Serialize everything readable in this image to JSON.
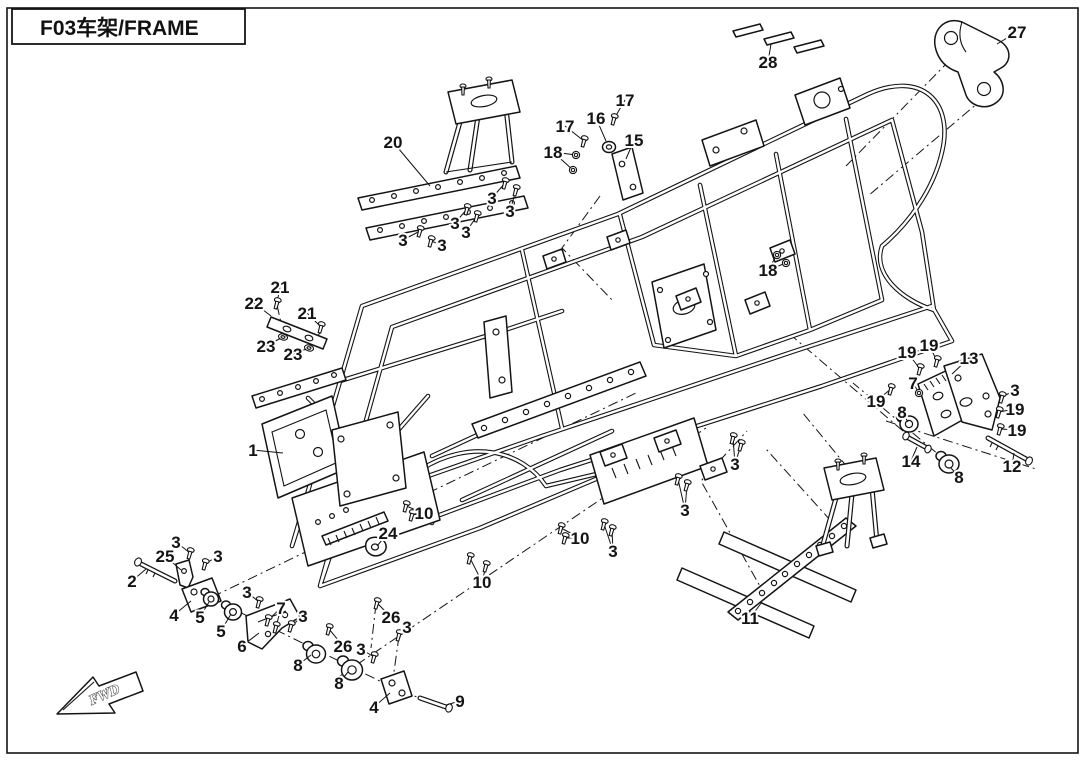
{
  "title": "F03车架/FRAME",
  "direction_label": "FWD",
  "colors": {
    "ink": "#141414",
    "paper": "#ffffff"
  },
  "callouts": [
    {
      "label": "20",
      "x": 393,
      "y": 142,
      "t": [
        [
          430,
          186
        ]
      ]
    },
    {
      "label": "3",
      "x": 492,
      "y": 198,
      "t": [
        [
          505,
          183
        ]
      ],
      "glyph": "bolt"
    },
    {
      "label": "3",
      "x": 510,
      "y": 211,
      "t": [
        [
          516,
          190
        ]
      ],
      "glyph": "bolt"
    },
    {
      "label": "3",
      "x": 455,
      "y": 223,
      "t": [
        [
          467,
          209
        ]
      ],
      "glyph": "bolt"
    },
    {
      "label": "3",
      "x": 466,
      "y": 232,
      "t": [
        [
          477,
          216
        ]
      ],
      "glyph": "bolt"
    },
    {
      "label": "3",
      "x": 403,
      "y": 240,
      "t": [
        [
          420,
          231
        ]
      ],
      "glyph": "bolt"
    },
    {
      "label": "3",
      "x": 442,
      "y": 245,
      "t": [
        [
          431,
          241
        ]
      ],
      "glyph": "bolt"
    },
    {
      "label": "17",
      "x": 625,
      "y": 100,
      "t": [
        [
          614,
          119
        ]
      ],
      "glyph": "bolt"
    },
    {
      "label": "16",
      "x": 596,
      "y": 118,
      "t": [
        [
          606,
          141
        ]
      ]
    },
    {
      "label": "17",
      "x": 565,
      "y": 126,
      "t": [
        [
          584,
          141
        ]
      ],
      "glyph": "bolt"
    },
    {
      "label": "15",
      "x": 634,
      "y": 140,
      "t": [
        [
          626,
          159
        ]
      ]
    },
    {
      "label": "18",
      "x": 553,
      "y": 152,
      "t": [
        [
          576,
          155
        ],
        [
          573,
          170
        ]
      ],
      "glyph": "nut"
    },
    {
      "label": "28",
      "x": 768,
      "y": 62,
      "t": [
        [
          771,
          44
        ]
      ]
    },
    {
      "label": "27",
      "x": 1017,
      "y": 32,
      "t": [
        [
          997,
          44
        ]
      ]
    },
    {
      "label": "21",
      "x": 280,
      "y": 287,
      "t": [
        [
          277,
          303
        ]
      ],
      "glyph": "bolt"
    },
    {
      "label": "22",
      "x": 254,
      "y": 303,
      "t": [
        [
          271,
          316
        ]
      ]
    },
    {
      "label": "21",
      "x": 307,
      "y": 313,
      "t": [
        [
          321,
          327
        ]
      ],
      "glyph": "bolt"
    },
    {
      "label": "23",
      "x": 266,
      "y": 346,
      "t": [
        [
          283,
          337
        ]
      ],
      "glyph": "washer"
    },
    {
      "label": "23",
      "x": 293,
      "y": 354,
      "t": [
        [
          309,
          348
        ]
      ],
      "glyph": "washer"
    },
    {
      "label": "1",
      "x": 253,
      "y": 450,
      "t": [
        [
          283,
          453
        ]
      ]
    },
    {
      "label": "18",
      "x": 768,
      "y": 270,
      "t": [
        [
          777,
          255
        ],
        [
          786,
          263
        ]
      ],
      "glyph": "nut"
    },
    {
      "label": "19",
      "x": 907,
      "y": 352,
      "t": [
        [
          920,
          369
        ]
      ],
      "glyph": "bolt"
    },
    {
      "label": "19",
      "x": 929,
      "y": 345,
      "t": [
        [
          937,
          361
        ]
      ],
      "glyph": "bolt"
    },
    {
      "label": "13",
      "x": 969,
      "y": 358,
      "t": [
        [
          952,
          374
        ]
      ]
    },
    {
      "label": "7",
      "x": 913,
      "y": 383,
      "t": [
        [
          919,
          393
        ]
      ],
      "glyph": "nut"
    },
    {
      "label": "19",
      "x": 876,
      "y": 401,
      "t": [
        [
          891,
          389
        ]
      ],
      "glyph": "bolt"
    },
    {
      "label": "3",
      "x": 1015,
      "y": 390,
      "t": [
        [
          1002,
          397
        ]
      ],
      "glyph": "bolt"
    },
    {
      "label": "19",
      "x": 1015,
      "y": 409,
      "t": [
        [
          999,
          412
        ]
      ],
      "glyph": "bolt"
    },
    {
      "label": "8",
      "x": 902,
      "y": 412,
      "t": [
        [
          908,
          422
        ]
      ]
    },
    {
      "label": "19",
      "x": 1017,
      "y": 430,
      "t": [
        [
          1000,
          429
        ]
      ],
      "glyph": "bolt"
    },
    {
      "label": "14",
      "x": 911,
      "y": 461,
      "t": [
        [
          917,
          447
        ]
      ]
    },
    {
      "label": "8",
      "x": 959,
      "y": 477,
      "t": [
        [
          951,
          468
        ]
      ]
    },
    {
      "label": "12",
      "x": 1012,
      "y": 466,
      "t": [
        [
          1014,
          453
        ]
      ]
    },
    {
      "label": "3",
      "x": 735,
      "y": 464,
      "t": [
        [
          733,
          438
        ],
        [
          741,
          445
        ]
      ],
      "glyph": "bolt"
    },
    {
      "label": "3",
      "x": 685,
      "y": 510,
      "t": [
        [
          678,
          479
        ],
        [
          687,
          485
        ]
      ],
      "glyph": "bolt"
    },
    {
      "label": "10",
      "x": 580,
      "y": 538,
      "t": [
        [
          561,
          528
        ],
        [
          565,
          538
        ]
      ],
      "glyph": "bolt"
    },
    {
      "label": "3",
      "x": 613,
      "y": 551,
      "t": [
        [
          604,
          524
        ],
        [
          612,
          530
        ]
      ],
      "glyph": "bolt"
    },
    {
      "label": "11",
      "x": 750,
      "y": 618,
      "t": [
        [
          762,
          602
        ]
      ]
    },
    {
      "label": "10",
      "x": 482,
      "y": 582,
      "t": [
        [
          470,
          558
        ],
        [
          486,
          566
        ]
      ],
      "glyph": "bolt"
    },
    {
      "label": "10",
      "x": 424,
      "y": 513,
      "t": [
        [
          406,
          506
        ],
        [
          412,
          515
        ]
      ],
      "glyph": "bolt"
    },
    {
      "label": "24",
      "x": 388,
      "y": 533,
      "t": [
        [
          377,
          546
        ]
      ]
    },
    {
      "label": "3",
      "x": 176,
      "y": 542,
      "t": [
        [
          190,
          553
        ]
      ],
      "glyph": "bolt"
    },
    {
      "label": "25",
      "x": 165,
      "y": 556,
      "t": [
        [
          181,
          570
        ]
      ]
    },
    {
      "label": "3",
      "x": 218,
      "y": 556,
      "t": [
        [
          205,
          564
        ]
      ],
      "glyph": "bolt"
    },
    {
      "label": "2",
      "x": 132,
      "y": 581,
      "t": [
        [
          146,
          569
        ]
      ]
    },
    {
      "label": "4",
      "x": 174,
      "y": 615,
      "t": [
        [
          191,
          601
        ]
      ]
    },
    {
      "label": "5",
      "x": 200,
      "y": 617,
      "t": [
        [
          209,
          602
        ]
      ]
    },
    {
      "label": "5",
      "x": 221,
      "y": 631,
      "t": [
        [
          231,
          614
        ]
      ]
    },
    {
      "label": "6",
      "x": 242,
      "y": 646,
      "t": [
        [
          259,
          633
        ]
      ]
    },
    {
      "label": "3",
      "x": 247,
      "y": 592,
      "t": [
        [
          259,
          602
        ]
      ],
      "glyph": "bolt"
    },
    {
      "label": "7",
      "x": 281,
      "y": 608,
      "t": [
        [
          268,
          620
        ],
        [
          276,
          627
        ]
      ],
      "glyph": "bolt"
    },
    {
      "label": "3",
      "x": 303,
      "y": 616,
      "t": [
        [
          291,
          626
        ]
      ],
      "glyph": "bolt"
    },
    {
      "label": "26",
      "x": 343,
      "y": 646,
      "t": [
        [
          329,
          629
        ]
      ],
      "glyph": "bolt"
    },
    {
      "label": "8",
      "x": 298,
      "y": 665,
      "t": [
        [
          311,
          655
        ]
      ]
    },
    {
      "label": "8",
      "x": 339,
      "y": 683,
      "t": [
        [
          348,
          672
        ]
      ]
    },
    {
      "label": "26",
      "x": 391,
      "y": 617,
      "t": [
        [
          377,
          603
        ]
      ],
      "glyph": "bolt"
    },
    {
      "label": "3",
      "x": 407,
      "y": 627,
      "t": [
        [
          399,
          635
        ]
      ],
      "glyph": "bolt"
    },
    {
      "label": "3",
      "x": 361,
      "y": 649,
      "t": [
        [
          374,
          657
        ]
      ],
      "glyph": "bolt"
    },
    {
      "label": "4",
      "x": 374,
      "y": 707,
      "t": [
        [
          390,
          693
        ]
      ]
    },
    {
      "label": "9",
      "x": 460,
      "y": 701,
      "t": [
        [
          446,
          705
        ]
      ]
    }
  ]
}
